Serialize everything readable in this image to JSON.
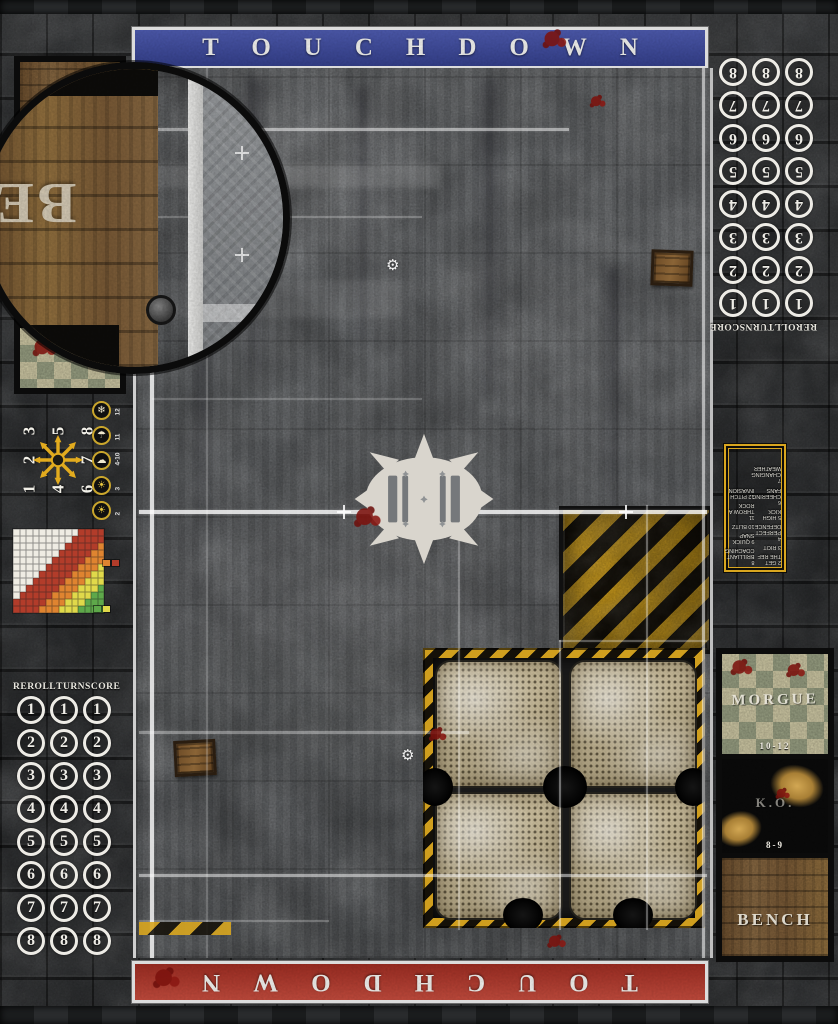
{
  "banners": {
    "top": {
      "label": "TOUCHDOWN",
      "color": "#3f4c9f"
    },
    "bottom": {
      "label": "TOUCHDOWN",
      "color": "#a83227"
    }
  },
  "turn_track": {
    "headers": [
      "REROLL",
      "TURN",
      "SCORE"
    ],
    "turns": [
      "1",
      "2",
      "3",
      "4",
      "5",
      "6",
      "7",
      "8"
    ],
    "columns": 3
  },
  "dugouts": {
    "morgue": {
      "label": "MORGUE",
      "dice_range": "10-12"
    },
    "knocked_out": {
      "label": "K.O.",
      "dice_range": "8-9"
    },
    "bench": {
      "label": "BENCH"
    }
  },
  "magnifier": {
    "visible_label": "BE"
  },
  "kickoff_table": {
    "column1": [
      {
        "roll": "2",
        "event": "GET THE REF"
      },
      {
        "roll": "3",
        "event": "RIOT"
      },
      {
        "roll": "4",
        "event": "PERFECT DEFENCE"
      },
      {
        "roll": "5",
        "event": "HIGH KICK"
      },
      {
        "roll": "6",
        "event": "CHEERING FANS"
      },
      {
        "roll": "7",
        "event": "CHANGING WEATHER"
      }
    ],
    "column2": [
      {
        "roll": "8",
        "event": "BRILLIANT COACHING"
      },
      {
        "roll": "9",
        "event": "QUICK SNAP"
      },
      {
        "roll": "10",
        "event": "BLITZ"
      },
      {
        "roll": "11",
        "event": "THROW A ROCK"
      },
      {
        "roll": "12",
        "event": "PITCH INVASION"
      }
    ]
  },
  "scatter_template": {
    "grid": [
      [
        "3",
        "5",
        "8"
      ],
      [
        "2",
        "",
        "7"
      ],
      [
        "1",
        "4",
        "6"
      ]
    ]
  },
  "weather_table": [
    {
      "roll": "12",
      "icon": "snowfall-icon",
      "glyph": "❄"
    },
    {
      "roll": "11",
      "icon": "rain-icon",
      "glyph": "☂"
    },
    {
      "roll": "4-10",
      "icon": "cloudy-icon",
      "glyph": "☁"
    },
    {
      "roll": "3",
      "icon": "sun-cloud-icon",
      "glyph": "☀"
    },
    {
      "roll": "2",
      "icon": "sun-icon",
      "glyph": "☀"
    }
  ],
  "range_ruler": {
    "columns": 14,
    "rows": 12,
    "metric": "col+row",
    "bands": [
      {
        "name": "quick-pass",
        "color": "#efece3",
        "max_distance": 9
      },
      {
        "name": "short-pass",
        "color": "#b23c2a",
        "max_distance": 14
      },
      {
        "name": "long-pass",
        "color": "#df8430",
        "max_distance": 17
      },
      {
        "name": "long-bomb",
        "color": "#e0d94a",
        "max_distance": 20
      },
      {
        "name": "beyond-range",
        "color": "#5ea84a",
        "max_distance": 99
      }
    ],
    "legend_mid": [
      "#df8430",
      "#b23c2a"
    ],
    "legend_bottom": [
      "#5ea84a",
      "#e0d94a"
    ]
  },
  "decor": {
    "gear_glyph": "⚙"
  },
  "colors": {
    "banner_top_blue": "#3f4c9f",
    "banner_bottom_red": "#a83227",
    "hazard_yellow": "#d9a61f",
    "gold_border": "#d9a61f",
    "blood_red": "#7c120d",
    "pitch_grey": "#84878a",
    "stone_grey": "#45474a"
  }
}
